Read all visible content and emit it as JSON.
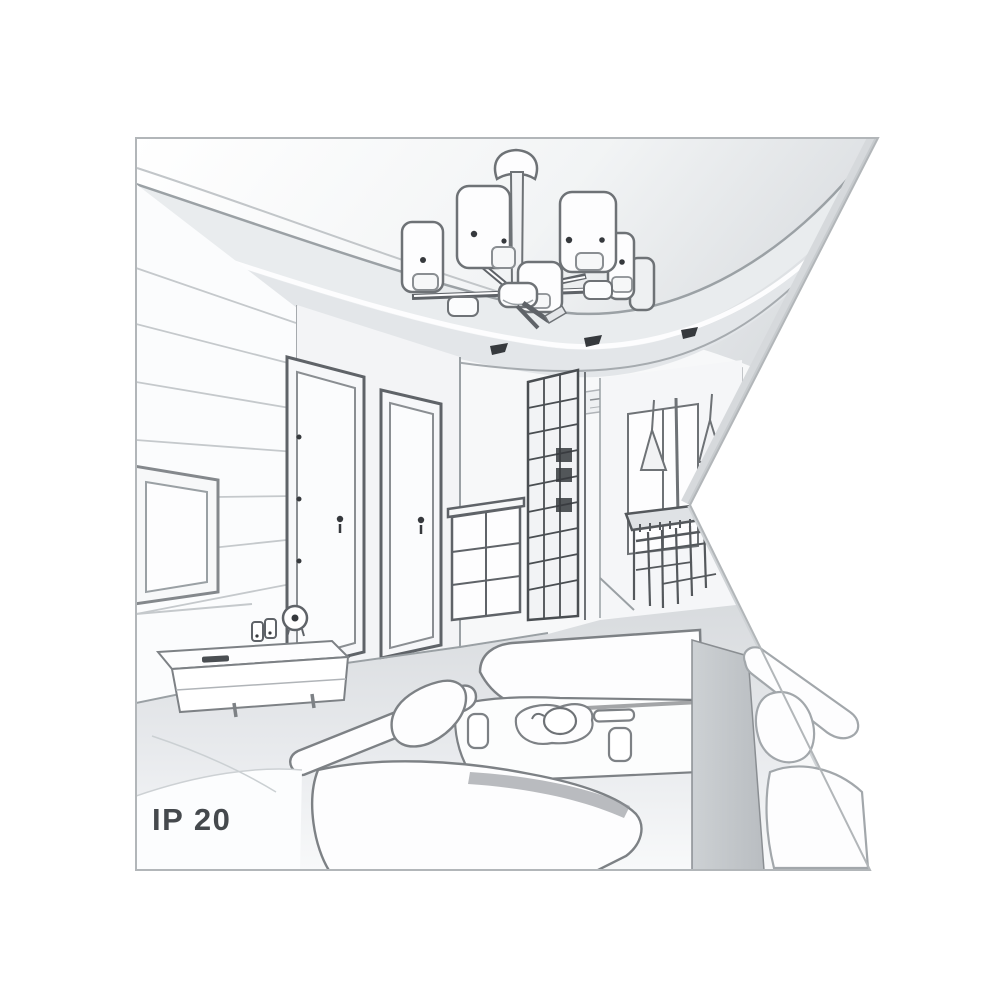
{
  "figure": {
    "type": "interior line-art illustration",
    "caption": "IP 20",
    "palette": {
      "background": "#ffffff",
      "frame_border": "#b2b6b9",
      "outline": "#7b7f83",
      "outline_dark": "#54585c",
      "outline_light": "#a9adb1",
      "fill_white": "#fdfdfe",
      "fill_light": "#f1f3f5",
      "fill_mid": "#e7eaec",
      "fill_shadow": "#cfd3d6",
      "accent_dark": "#36393d",
      "text": "#45494d"
    },
    "scene": {
      "elements": [
        "ceiling-chandelier-with-cylindrical-shades",
        "recessed-ceiling-spotlights",
        "paneled-tv-wall",
        "wall-mounted-tv",
        "media-sideboard-with-clock-and-speakers",
        "interior-door-left",
        "interior-door-right",
        "drawer-chest",
        "glass-block-cabinet",
        "hallway-window",
        "cone-pendant-lamps",
        "dining-table-with-chairs",
        "chaise-seat",
        "coffee-table-with-tray-and-cups",
        "sofa-left",
        "sofa-right"
      ]
    }
  }
}
